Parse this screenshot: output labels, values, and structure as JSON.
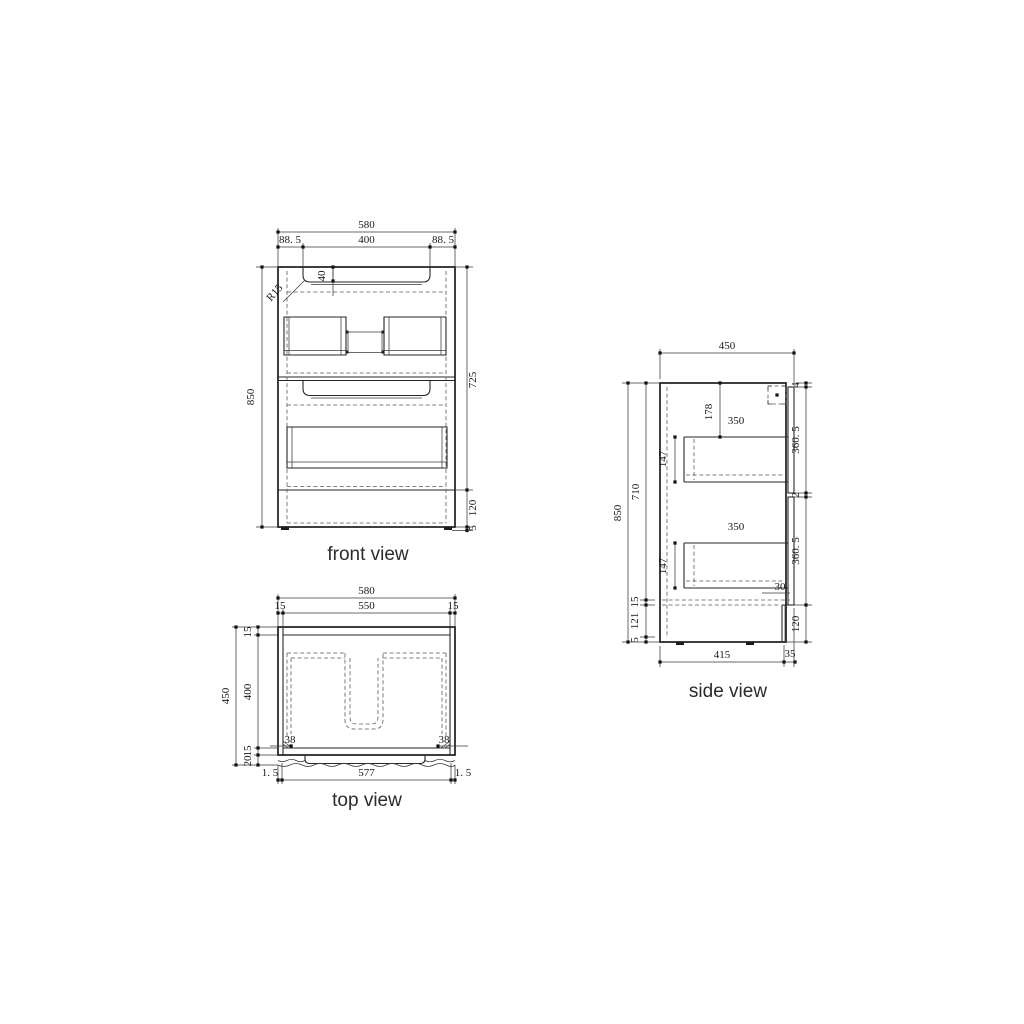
{
  "views": {
    "front": {
      "label": "front view",
      "dims": {
        "overall_width": "580",
        "left_margin": "88. 5",
        "handle_width": "400",
        "right_margin": "88. 5",
        "handle_depth": "40",
        "corner_radius": "R15",
        "overall_height": "850",
        "body_height": "725",
        "kick_height": "120",
        "base_gap": "5"
      }
    },
    "side": {
      "label": "side view",
      "dims": {
        "overall_depth": "450",
        "top_gap": "4",
        "basin_drop": "178",
        "upper_drawer_depth": "350",
        "upper_front_height": "360. 5",
        "door_gap": "2",
        "upper_drawer_height": "147",
        "overall_height": "850",
        "carcass_height": "710",
        "lower_drawer_depth": "350",
        "lower_drawer_height": "147",
        "lower_front_height": "360. 5",
        "front_overhang": "30",
        "bottom_clearance": "15",
        "kick_height_left": "121",
        "base_gap": "5",
        "kick_height_right": "120",
        "base_depth": "415",
        "kick_setback": "35"
      }
    },
    "top": {
      "label": "top view",
      "dims": {
        "overall_width": "580",
        "left_wall": "15",
        "inner_width": "550",
        "right_wall": "15",
        "overall_depth": "450",
        "back_wall": "15",
        "inner_depth": "400",
        "front_rail": "15",
        "front_overhang": "20",
        "left_bracket": "38",
        "right_bracket": "38",
        "front_left_gap": "1. 5",
        "front_panel_width": "577",
        "front_right_gap": "1. 5"
      }
    }
  }
}
